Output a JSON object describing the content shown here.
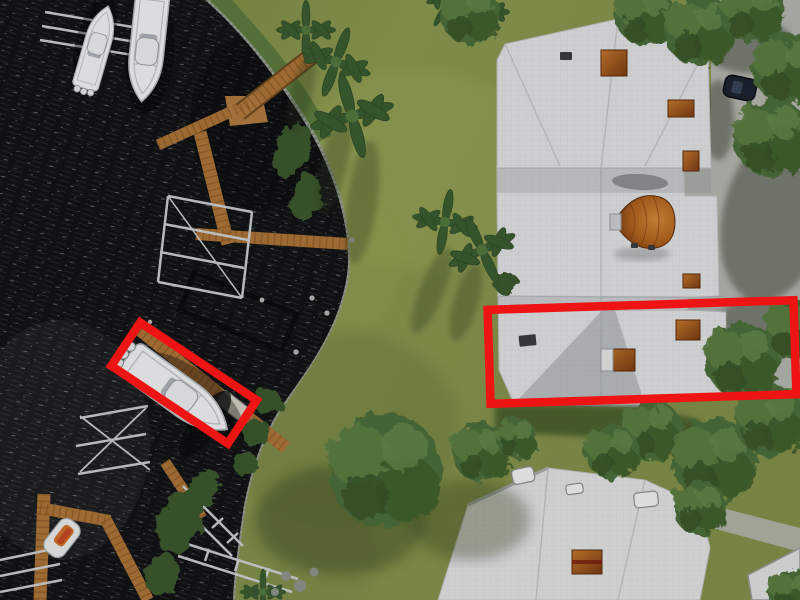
{
  "image": {
    "kind": "aerial-drone-photo",
    "description": "Top-down aerial photo of a waterfront community: dark canal water with wooden docks, aluminum boat lifts and white boats on the left; a green lawn with palm trees and one large leafy tree in the center; white shingle-roofed condo buildings with a copper roof dome, copper chimney caps and a concrete driveway with a parked dark car on the right. Two thick red rectangle annotations highlight a docked white boat and a roof section of the waterfront home.",
    "width_px": 800,
    "height_px": 600
  },
  "palette": {
    "annotation_red": "#ee1414",
    "water": "#121416",
    "grass": "#8a974f",
    "roof_white": "#e4e6e7",
    "dock_wood": "#b0763a",
    "copper": "#b9651f",
    "driveway": "#b5b9b0",
    "tree_green": "#4e6f3a",
    "boat_white": "#f3f5f6",
    "rock_gray": "#9fa89e"
  },
  "annotations": [
    {
      "id": "boat-box",
      "label": "red highlight around white boat docked at wooden pier",
      "color": "#ee1414",
      "approx_center_px": [
        184,
        383
      ],
      "approx_size_px": [
        140,
        52
      ],
      "rotation_deg": 33.7
    },
    {
      "id": "roof-box",
      "label": "red highlight around white roof section of waterfront condo",
      "color": "#ee1414",
      "approx_center_px": [
        642,
        352
      ],
      "approx_size_px": [
        306,
        94
      ],
      "rotation_deg": -1.8
    }
  ],
  "scene": {
    "water": "dark canal water with wave streaks",
    "boats": [
      "large white center-console boat (top left)",
      "white boat on lift beside it",
      "highlighted white center-console boat at angled dock",
      "small white skiff with orange kayaks (bottom left)"
    ],
    "docks": "orange-brown wooden docks with aluminum boat-lift cradles",
    "shoreline": "gray rock riprap edge with green hedges and mangrove bushes",
    "lawn": "green lawn with palm trees casting long shadows and a large leafy tree",
    "buildings": [
      "white-roof condo building with copper cupola dome and copper chimney caps (top right)",
      "white-roof home with skylights (bottom right)"
    ],
    "driveway": "concrete driveway with tree shadows and one parked dark car"
  }
}
